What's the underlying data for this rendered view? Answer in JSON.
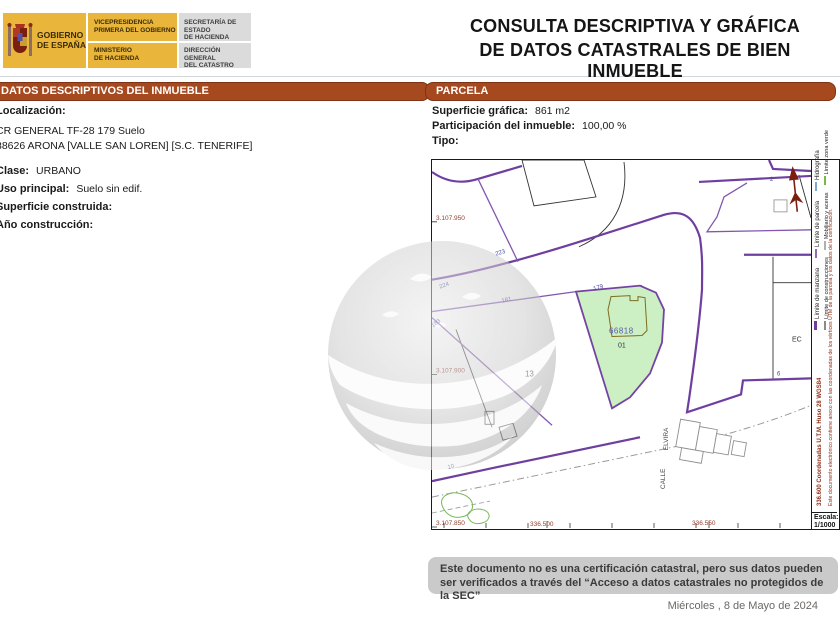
{
  "header": {
    "logo": {
      "box1": {
        "line1": "GOBIERNO",
        "line2": "DE ESPAÑA"
      },
      "box2": {
        "top1": "VICEPRESIDENCIA",
        "top2": "PRIMERA DEL GOBIERNO",
        "bottom1": "MINISTERIO",
        "bottom2": "DE HACIENDA"
      },
      "box3": {
        "top1": "SECRETARÍA DE ESTADO",
        "top2": "DE HACIENDA",
        "bottom1": "DIRECCIÓN GENERAL",
        "bottom2": "DEL CATASTRO"
      }
    },
    "title_line1": "CONSULTA DESCRIPTIVA Y GRÁFICA",
    "title_line2": "DE DATOS CATASTRALES DE BIEN INMUEBLE",
    "ref_label": "Referencia catastral:",
    "ref_value": "6681801CS3068S0001SE"
  },
  "left_panel": {
    "header": "DATOS DESCRIPTIVOS DEL INMUEBLE",
    "loc_label": "Localización:",
    "addr1": "CR GENERAL TF-28 179 Suelo",
    "addr2": "38626 ARONA [VALLE SAN LOREN] [S.C. TENERIFE]",
    "clase_label": "Clase:",
    "clase_value": "URBANO",
    "uso_label": "Uso principal:",
    "uso_value": "Suelo sin edif.",
    "sup_label": "Superficie construida:",
    "sup_value": "",
    "ano_label": "Año construcción:",
    "ano_value": ""
  },
  "parcela": {
    "header": "PARCELA",
    "sg_label": "Superficie gráfica:",
    "sg_value": "861 m2",
    "part_label": "Participación del inmueble:",
    "part_value": "100,00 %",
    "tipo_label": "Tipo:",
    "tipo_value": ""
  },
  "map": {
    "coords": {
      "y1": "3.107.950",
      "y2": "3.107.900",
      "y3": "3.107.850",
      "x1": "336.500",
      "x2": "336.550"
    },
    "road_numbers": {
      "n223": "223",
      "n224": "224",
      "n181": "181",
      "n183": "183",
      "n179": "179",
      "n10": "10",
      "n6": "6",
      "n2": "2"
    },
    "parcel_labels": {
      "p13": "13",
      "ref": "66818",
      "sub": "01",
      "ec": "EC"
    },
    "street": {
      "line1": "ELVIRA",
      "line2": "CALLE"
    },
    "legend": {
      "line1": [
        {
          "label": "Límite de manzana",
          "color": "#6F3FA0"
        },
        {
          "label": "Límite de parcela",
          "color": "#8E6BB5"
        },
        {
          "label": "Hidrografía",
          "color": "#7FA8C8"
        }
      ],
      "line2": [
        {
          "label": "Límite de construcciones",
          "color": "#8A8A8A"
        },
        {
          "label": "Mobiliario y aceras",
          "color": "#B0B0B0"
        },
        {
          "label": "Límite zona verde",
          "color": "#7AB648"
        }
      ]
    },
    "side_text_1": "336.600 Coordenadas U.T.M. Huso 28 WGS84",
    "side_text_2": "Este documento electrónico contiene anexo con las coordenadas de los vértices UTM de la parcela y los datos de la certificación.",
    "scale_label": "Escala:",
    "scale_value": "1/1000"
  },
  "footer": {
    "disclaimer": "Este documento no es una certificación catastral, pero sus datos pueden ser verificados a través del “Acceso a datos catastrales no protegidos de la SEC”",
    "date": "Miércoles , 8 de Mayo de 2024"
  },
  "colors": {
    "section_bar": "#A6491F",
    "gov_yellow": "#E9B63B",
    "map_purple_thick": "#6F3FA0",
    "map_purple_thin": "#8257B0",
    "parcel_green_fill": "#CDEFC4",
    "coord_label_red": "#94402E",
    "side_text_red": "#8C2F1B",
    "road_number_blue": "#4646A0",
    "disclaimer_gray": "#CACACA"
  }
}
